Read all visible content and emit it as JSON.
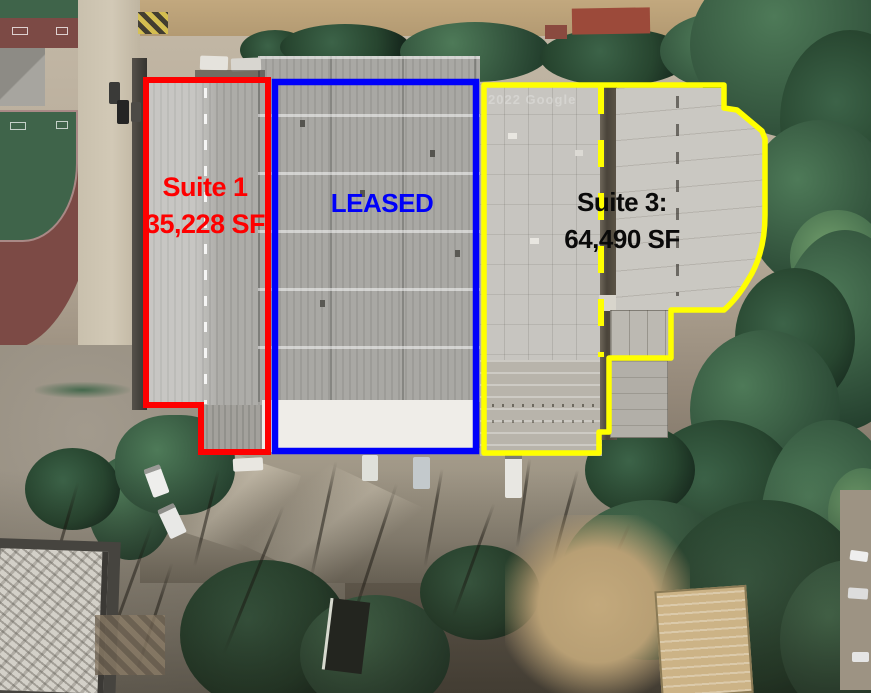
{
  "watermark": "2022 Google",
  "suites": {
    "suite1": {
      "name": "Suite 1",
      "area": "35,228 SF",
      "color": "#fe0000"
    },
    "leased": {
      "label": "LEASED",
      "color": "#0000fa"
    },
    "suite3": {
      "name": "Suite 3:",
      "area": "64,490 SF",
      "outline_color": "#ffff00",
      "text_color": "#0a0a0a"
    }
  }
}
